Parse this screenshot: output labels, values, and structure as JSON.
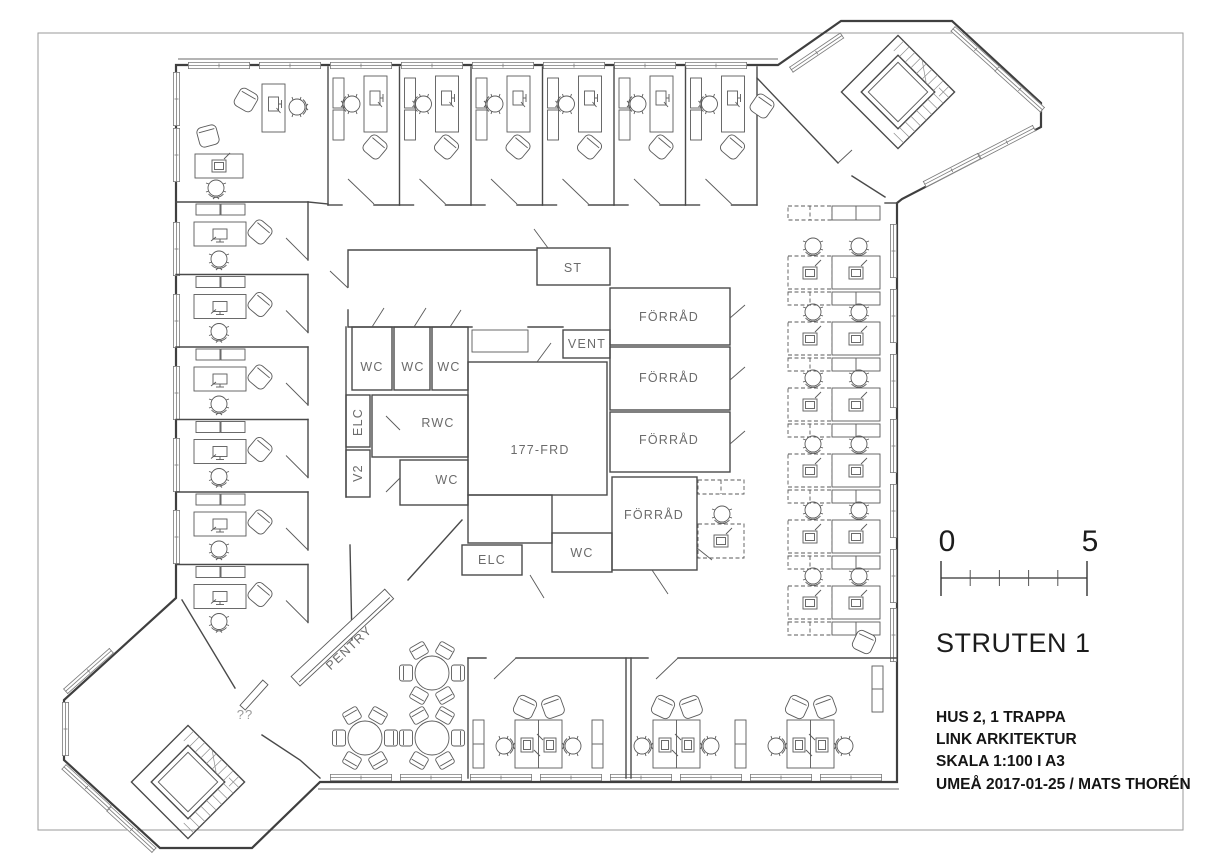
{
  "colors": {
    "background": "#ffffff",
    "line": "#3f3f3f",
    "label": "#6b6b6b"
  },
  "rooms": {
    "st": "ST",
    "vent": "VENT",
    "forrad_1": "FÖRRÅD",
    "forrad_2": "FÖRRÅD",
    "forrad_3": "FÖRRÅD",
    "forrad_4": "FÖRRÅD",
    "wc_1": "WC",
    "wc_2": "WC",
    "wc_3": "WC",
    "wc_4": "WC",
    "wc_5": "WC",
    "rwc": "RWC",
    "elc_1": "ELC",
    "elc_2": "ELC",
    "v2": "V2",
    "frd_177": "177-FRD",
    "pentry": "PENTRY",
    "unknown_marker": "??"
  },
  "scale_bar": {
    "start": "0",
    "end": "5"
  },
  "title_block": {
    "project": "STRUTEN 1",
    "lines": [
      "HUS 2, 1 TRAPPA",
      "LINK ARKITEKTUR",
      "SKALA 1:100 I A3",
      "UMEÅ 2017-01-25 / MATS THORÉN"
    ]
  }
}
